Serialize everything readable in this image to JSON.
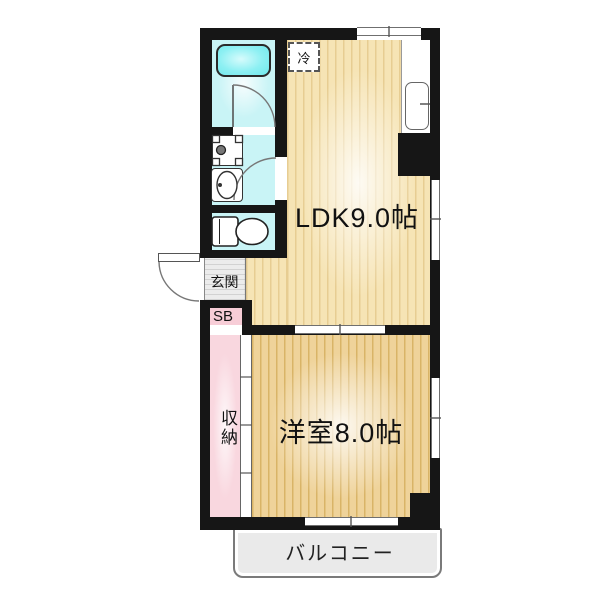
{
  "floorplan": {
    "type": "japanese-apartment-1ldk",
    "rooms": {
      "ldk": {
        "label": "LDK9.0帖",
        "size_jo": 9.0
      },
      "western_room": {
        "label": "洋室8.0帖",
        "size_jo": 8.0
      },
      "storage_closet": {
        "label": "収納"
      },
      "entrance": {
        "label": "玄関"
      },
      "shoe_box": {
        "label": "SB"
      },
      "refrigerator_space": {
        "label": "冷"
      },
      "balcony": {
        "label": "バルコニー"
      }
    },
    "fixtures": [
      "bathtub",
      "bathroom-door",
      "washing-machine-pan",
      "vanity-sink",
      "toilet",
      "kitchen-sink",
      "entrance-door",
      "sliding-closet-door",
      "windows",
      "sliding-partition"
    ],
    "colors": {
      "wall": "#161616",
      "ldk_floor": "#f6e4b5",
      "ldk_floor_stripe": "#e7cd92",
      "western_floor": "#efd39a",
      "western_floor_stripe": "#d9b467",
      "wet_room_cyan": "#c9f4f6",
      "bathtub_cyan": "#8df0f3",
      "storage_pink": "#f9d7df",
      "entrance_gray": "#e4e4e4",
      "balcony_gray": "#eaeaea",
      "background": "#ffffff"
    }
  }
}
